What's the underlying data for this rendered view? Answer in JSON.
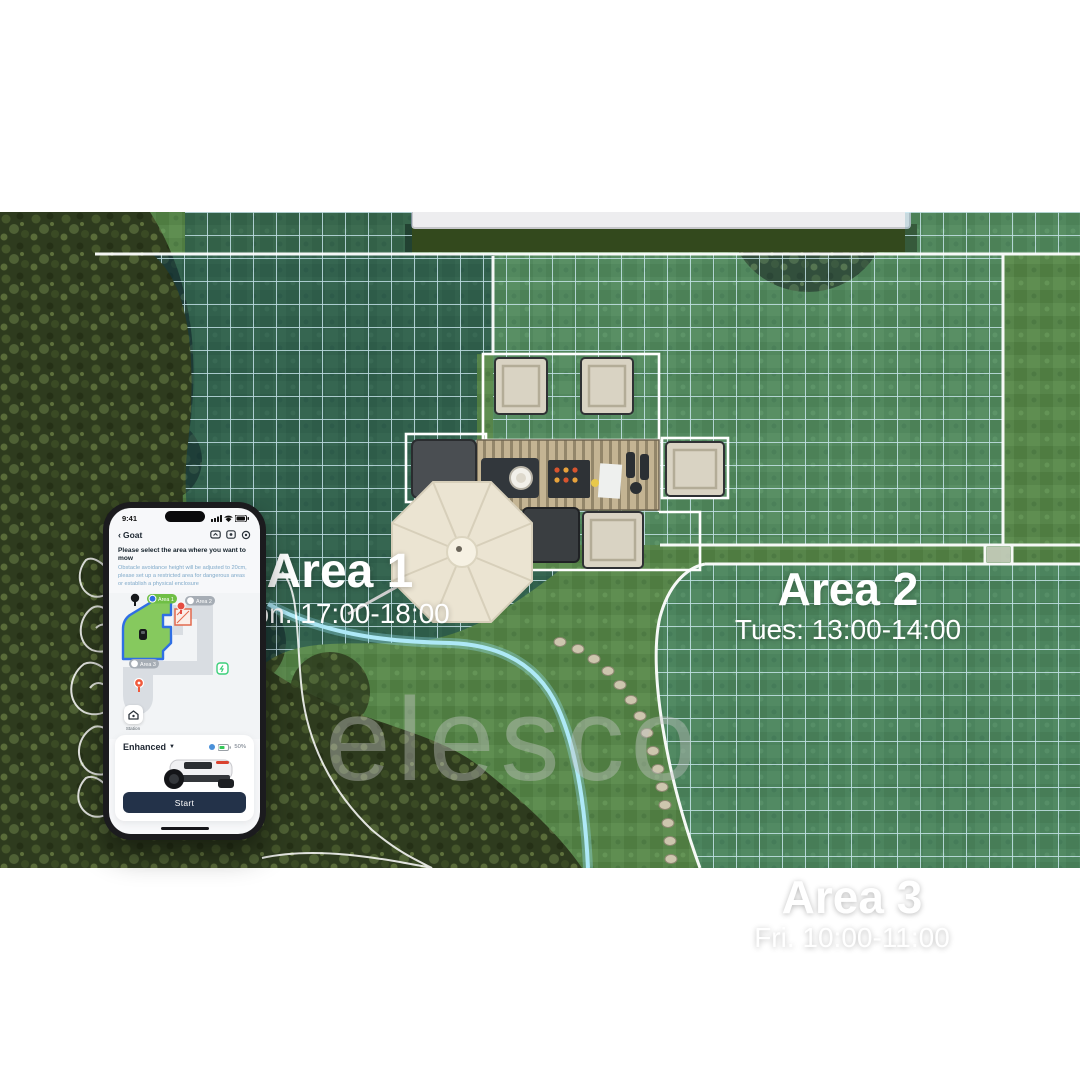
{
  "scene": {
    "areas": [
      {
        "name": "Area 1",
        "schedule": "Mon. 17:00-18:00"
      },
      {
        "name": "Area 2",
        "schedule": "Tues: 13:00-14:00"
      },
      {
        "name": "Area 3",
        "schedule": "Fri. 10:00-11:00"
      }
    ],
    "watermark": "elesco"
  },
  "phone": {
    "status": {
      "time": "9:41"
    },
    "nav": {
      "back_chevron": "‹",
      "title": "Goat"
    },
    "instruction": {
      "title": "Please select the area where you want to mow",
      "subtitle": "Obstacle avoidance height will be adjusted to 20cm, please set up a restricted area for dangerous areas or establish a physical enclosure"
    },
    "map": {
      "area1_label": "Area 1",
      "area2_label": "Area 2",
      "area3_label": "Area 3",
      "station_label": "Station"
    },
    "controls": {
      "mode": "Enhanced",
      "battery": "50%",
      "start": "Start"
    },
    "colors": {
      "map_area_green": "#86c95e",
      "map_outline_blue": "#2f6fe4",
      "restricted_red": "#e2694d",
      "battery_green": "#35c759",
      "start_bg": "#233249",
      "grid_teal": "#bfe5f2"
    }
  }
}
